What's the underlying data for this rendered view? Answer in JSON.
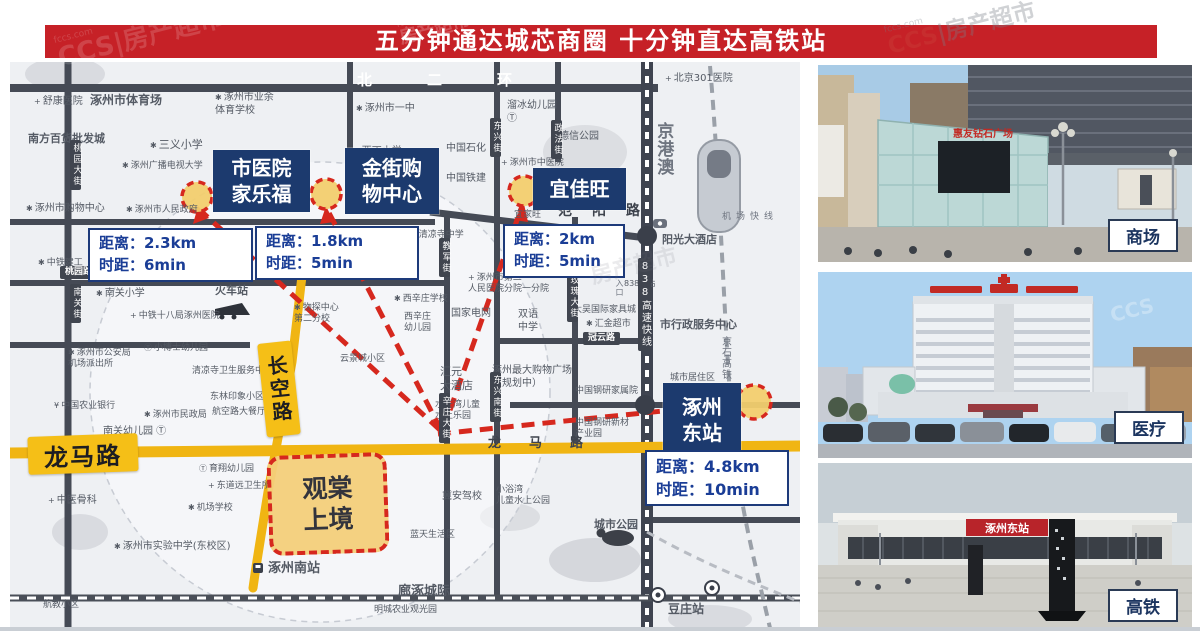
{
  "header": {
    "title": "五分钟通达城芯商圈 十分钟直达高铁站"
  },
  "watermark": {
    "logo": "CCS",
    "brand": "房产超市",
    "site": "fccs.com"
  },
  "map": {
    "property": {
      "line1": "观棠",
      "line2": "上境"
    },
    "longma_label": "龙马路",
    "changkong_label": "长空路",
    "pois": [
      {
        "line1": "市医院",
        "line2": "家乐福",
        "distance": "距离：2.3km",
        "time": "时距：6min"
      },
      {
        "line1": "金街购",
        "line2": "物中心",
        "distance": "距离：1.8km",
        "time": "时距：5min"
      },
      {
        "line1": "宜佳旺",
        "distance": "距离：2km",
        "time": "时距：5min"
      },
      {
        "line1": "涿州",
        "line2": "东站",
        "distance": "距离：4.8km",
        "time": "时距：10min"
      }
    ],
    "places": [
      {
        "t": "舒康医院",
        "x": 24,
        "y": 34,
        "i": "+"
      },
      {
        "t": "涿州市体育场",
        "x": 80,
        "y": 31,
        "s": 12,
        "b": 1
      },
      {
        "t": "涿州市业余\n体育学校",
        "x": 205,
        "y": 30,
        "i": "✱"
      },
      {
        "t": "南方百货批发城",
        "x": 18,
        "y": 70,
        "s": 11,
        "b": 1
      },
      {
        "t": "三义小学",
        "x": 140,
        "y": 76,
        "i": "✱",
        "s": 11
      },
      {
        "t": "涿州广播电视大学",
        "x": 112,
        "y": 99,
        "i": "✱",
        "s": 9
      },
      {
        "t": "涿州市购物中心",
        "x": 16,
        "y": 141,
        "i": "✱"
      },
      {
        "t": "涿州市人民政府",
        "x": 116,
        "y": 143,
        "i": "✱",
        "s": 9
      },
      {
        "t": "涿州市一中",
        "x": 346,
        "y": 41,
        "i": "✱"
      },
      {
        "t": "西丁小学",
        "x": 343,
        "y": 84,
        "i": "✱"
      },
      {
        "t": "中国石化",
        "x": 436,
        "y": 81
      },
      {
        "t": "中国铁建",
        "x": 436,
        "y": 111
      },
      {
        "t": "溜冰幼儿园\nⓉ",
        "x": 497,
        "y": 38
      },
      {
        "t": "德信公园",
        "x": 549,
        "y": 69
      },
      {
        "t": "涿州市中医院",
        "x": 491,
        "y": 96,
        "i": "+",
        "s": 9
      },
      {
        "t": "宜家旺",
        "x": 504,
        "y": 148,
        "s": 9
      },
      {
        "t": "北京301医院",
        "x": 655,
        "y": 11,
        "i": "+"
      },
      {
        "t": "阳光大酒店",
        "x": 652,
        "y": 171,
        "s": 11,
        "b": 1
      },
      {
        "t": "市行政服务中心",
        "x": 650,
        "y": 256,
        "s": 11,
        "b": 1
      },
      {
        "t": "大吴国际家具城",
        "x": 563,
        "y": 243,
        "s": 9
      },
      {
        "t": "汇金超市",
        "x": 576,
        "y": 257,
        "i": "✱",
        "s": 9
      },
      {
        "t": "涿州市第二\n人民医院分院一分院",
        "x": 458,
        "y": 211,
        "i": "+",
        "s": 9
      },
      {
        "t": "国家电网",
        "x": 441,
        "y": 246
      },
      {
        "t": "双语\n中学",
        "x": 508,
        "y": 247
      },
      {
        "t": "西辛庄学校",
        "x": 384,
        "y": 232,
        "i": "✱",
        "s": 9
      },
      {
        "t": "西辛庄\n幼儿园",
        "x": 394,
        "y": 250,
        "s": 9
      },
      {
        "t": "清凉寺中学",
        "x": 400,
        "y": 168,
        "i": "✱",
        "s": 9
      },
      {
        "t": "庄稼医院",
        "x": 362,
        "y": 200,
        "s": 9
      },
      {
        "t": "火车站",
        "x": 205,
        "y": 222,
        "s": 11,
        "b": 1
      },
      {
        "t": "中铁十八局涿州医院",
        "x": 120,
        "y": 249,
        "i": "+",
        "s": 9
      },
      {
        "t": "南关小学",
        "x": 86,
        "y": 226,
        "i": "✱"
      },
      {
        "t": "涿州市公安局\n机场派出所",
        "x": 58,
        "y": 286,
        "i": "✱",
        "s": 9
      },
      {
        "t": "小博士幼儿园",
        "x": 134,
        "y": 281,
        "i": "Ⓣ",
        "s": 9
      },
      {
        "t": "清凉寺卫生服务中心",
        "x": 182,
        "y": 304,
        "s": 9
      },
      {
        "t": "东林印象小区",
        "x": 200,
        "y": 330,
        "s": 9
      },
      {
        "t": "航空路大餐厅",
        "x": 202,
        "y": 345,
        "s": 9
      },
      {
        "t": "中国农业银行",
        "x": 44,
        "y": 339,
        "i": "¥",
        "s": 9
      },
      {
        "t": "涿州市民政局",
        "x": 134,
        "y": 348,
        "i": "✱",
        "s": 9
      },
      {
        "t": "南关幼儿园 Ⓣ",
        "x": 93,
        "y": 364
      },
      {
        "t": "中医骨科",
        "x": 38,
        "y": 433,
        "i": "+"
      },
      {
        "t": "育翔幼儿园",
        "x": 189,
        "y": 402,
        "i": "Ⓣ",
        "s": 9
      },
      {
        "t": "东道远卫生所",
        "x": 198,
        "y": 419,
        "i": "+",
        "s": 9
      },
      {
        "t": "机场学校",
        "x": 178,
        "y": 441,
        "i": "✱",
        "s": 9
      },
      {
        "t": "涿州市实验中学(东校区)",
        "x": 104,
        "y": 479,
        "i": "✱",
        "s": 10
      },
      {
        "t": "航教小区",
        "x": 33,
        "y": 538,
        "s": 9
      },
      {
        "t": "涿州南站",
        "x": 258,
        "y": 499,
        "s": 13,
        "b": 1
      },
      {
        "t": "明城农业观光园",
        "x": 364,
        "y": 543,
        "s": 9
      },
      {
        "t": "廊涿城际",
        "x": 388,
        "y": 522,
        "s": 13,
        "b": 1
      },
      {
        "t": "豆庄站",
        "x": 658,
        "y": 540,
        "s": 12,
        "b": 1
      },
      {
        "t": "城市公园",
        "x": 584,
        "y": 456,
        "s": 11,
        "b": 1
      },
      {
        "t": "小浴湾\n儿童水上公园",
        "x": 486,
        "y": 423,
        "s": 9
      },
      {
        "t": "冀安驾校",
        "x": 432,
        "y": 429,
        "s": 10
      },
      {
        "t": "蓝天生活区",
        "x": 400,
        "y": 468,
        "s": 9
      },
      {
        "t": "云景城小区",
        "x": 330,
        "y": 292,
        "s": 9
      },
      {
        "t": "汇元\n大酒店",
        "x": 430,
        "y": 303,
        "s": 11
      },
      {
        "t": "涿州最大购物广场\n（规划中）",
        "x": 482,
        "y": 303,
        "s": 10
      },
      {
        "t": "中国钢研家属院",
        "x": 565,
        "y": 324,
        "s": 9
      },
      {
        "t": "中国钢研新材\n产业园",
        "x": 565,
        "y": 356,
        "s": 9
      },
      {
        "t": "水狂湾儿童\n水上乐园",
        "x": 425,
        "y": 338,
        "s": 9
      },
      {
        "t": "物探中心\n第二分校",
        "x": 284,
        "y": 241,
        "i": "✱",
        "s": 9
      },
      {
        "t": "城市居住区",
        "x": 660,
        "y": 311,
        "s": 9
      },
      {
        "t": "838车站",
        "x": 614,
        "y": 217,
        "s": 8
      },
      {
        "t": "中铁建工",
        "x": 28,
        "y": 196,
        "i": "✱",
        "s": 9
      },
      {
        "t": "工幼儿园",
        "x": 158,
        "y": 194,
        "s": 9
      },
      {
        "t": "高速出入口",
        "x": 604,
        "y": 190,
        "s": 8,
        "k": "vert grey"
      },
      {
        "t": "京港澳",
        "x": 642,
        "y": 60,
        "s": 17,
        "b": 1,
        "k": "vert grey"
      },
      {
        "t": "京石高铁",
        "x": 708,
        "y": 274,
        "s": 10,
        "k": "vert grey"
      },
      {
        "t": "机场快线",
        "x": 712,
        "y": 150,
        "s": 9,
        "k": "grey",
        "ls": 5
      },
      {
        "t": "北二环",
        "x": 347,
        "y": 9,
        "s": 15,
        "k": "roadname",
        "ls": 55
      },
      {
        "t": "范阳路",
        "x": 548,
        "y": 141,
        "s": 14,
        "k": "roadname2",
        "ls": 20
      },
      {
        "t": "龙马路",
        "x": 478,
        "y": 374,
        "s": 13,
        "k": "roadname2",
        "ls": 28
      },
      {
        "t": "冠云路",
        "x": 573,
        "y": 270,
        "s": 9,
        "k": "tag"
      },
      {
        "t": "桃园路",
        "x": 50,
        "y": 204,
        "s": 9,
        "k": "tag"
      }
    ],
    "streets": [
      {
        "t": "桃园大街",
        "x": 60,
        "y": 78
      },
      {
        "t": "南关街",
        "x": 60,
        "y": 222
      },
      {
        "t": "东兴街",
        "x": 480,
        "y": 56
      },
      {
        "t": "政法街",
        "x": 541,
        "y": 58
      },
      {
        "t": "教军街",
        "x": 429,
        "y": 176
      },
      {
        "t": "玫瑰大街",
        "x": 557,
        "y": 210
      },
      {
        "t": "辛庄大街",
        "x": 429,
        "y": 331
      },
      {
        "t": "东兴南街",
        "x": 480,
        "y": 310
      },
      {
        "t": "838高速快线",
        "x": 628,
        "y": 196,
        "s": 10
      }
    ]
  },
  "photos": [
    {
      "label": "商场",
      "building_sign": "惠友钻石广场"
    },
    {
      "label": "医疗"
    },
    {
      "label": "高铁",
      "station_sign": "涿州东站"
    }
  ]
}
